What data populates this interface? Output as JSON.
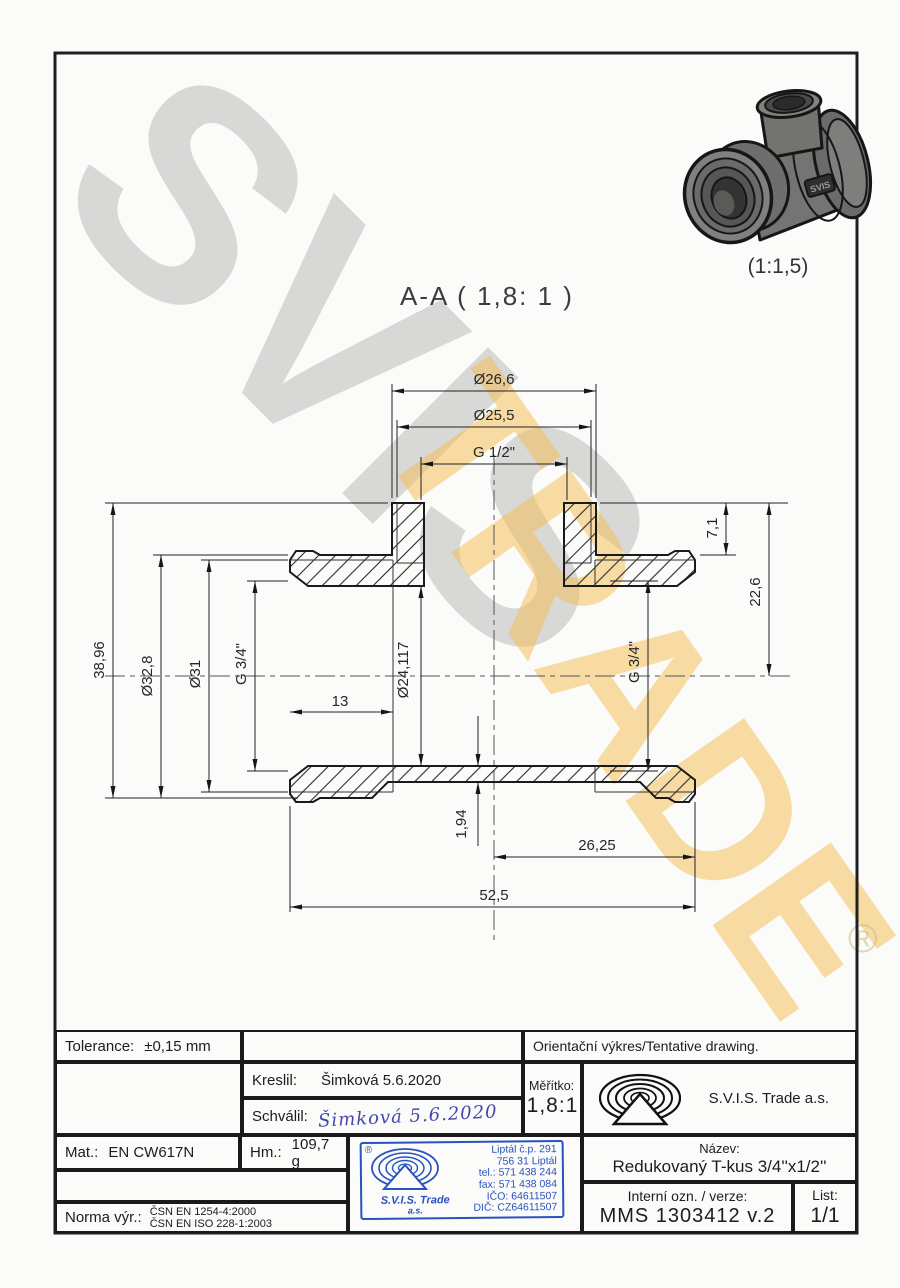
{
  "watermark": {
    "word1": "SVIS",
    "word2": "TRADE",
    "registered": "®",
    "gray": "#bcbcbc",
    "gold": "#f3bb4e"
  },
  "view": {
    "section_title": "A-A ( 1,8: 1 )",
    "render_scale": "(1:1,5)",
    "render_badge": "SVIS"
  },
  "drawing": {
    "dims": {
      "dia_26_6": "Ø26,6",
      "dia_25_5": "Ø25,5",
      "g_half": "G 1/2\"",
      "h_38_96": "38,96",
      "dia_32_8": "Ø32,8",
      "dia_31": "Ø31",
      "g_34_left": "G 3/4\"",
      "h_7_1": "7,1",
      "h_22_6": "22,6",
      "g_34_right": "G 3/4\"",
      "len_13": "13",
      "dia_24_117": "Ø24,117",
      "t_1_94": "1,94",
      "len_26_25": "26,25",
      "len_52_5": "52,5"
    }
  },
  "titleblock": {
    "tolerance": {
      "label": "Tolerance:",
      "value": "±0,15 mm"
    },
    "orientacni": "Orientační výkres/Tentative drawing.",
    "kreslil": {
      "label": "Kreslil:",
      "value": "Šimková 5.6.2020"
    },
    "schvalil": {
      "label": "Schválil:",
      "signature": "Šimková 5.6.2020"
    },
    "meritko": {
      "label": "Měřítko:",
      "value": "1,8:1"
    },
    "company": "S.V.I.S. Trade a.s.",
    "mat": {
      "label": "Mat.:",
      "value": "EN CW617N"
    },
    "hm": {
      "label": "Hm.:",
      "value": "109,7 g"
    },
    "norma": {
      "label": "Norma výr.:",
      "line1": "ČSN EN 1254-4:2000",
      "line2": "ČSN EN ISO 228-1:2003"
    },
    "nazev": {
      "label": "Název:",
      "value": "Redukovaný T-kus 3/4''x1/2''"
    },
    "interni": {
      "label": "Interní ozn. / verze:",
      "value": "MMS 1303412 v.2"
    },
    "list": {
      "label": "List:",
      "value": "1/1"
    },
    "stamp": {
      "registered": "®",
      "company": "S.V.I.S. Trade",
      "suffix": "a.s.",
      "lines": [
        "Liptál č.p. 291",
        "756 31 Liptál",
        "tel.: 571 438 244",
        "fax: 571 438 084",
        "IČO: 64611507",
        "DIČ: CZ64611507"
      ],
      "blue": "#2a52c0"
    }
  }
}
